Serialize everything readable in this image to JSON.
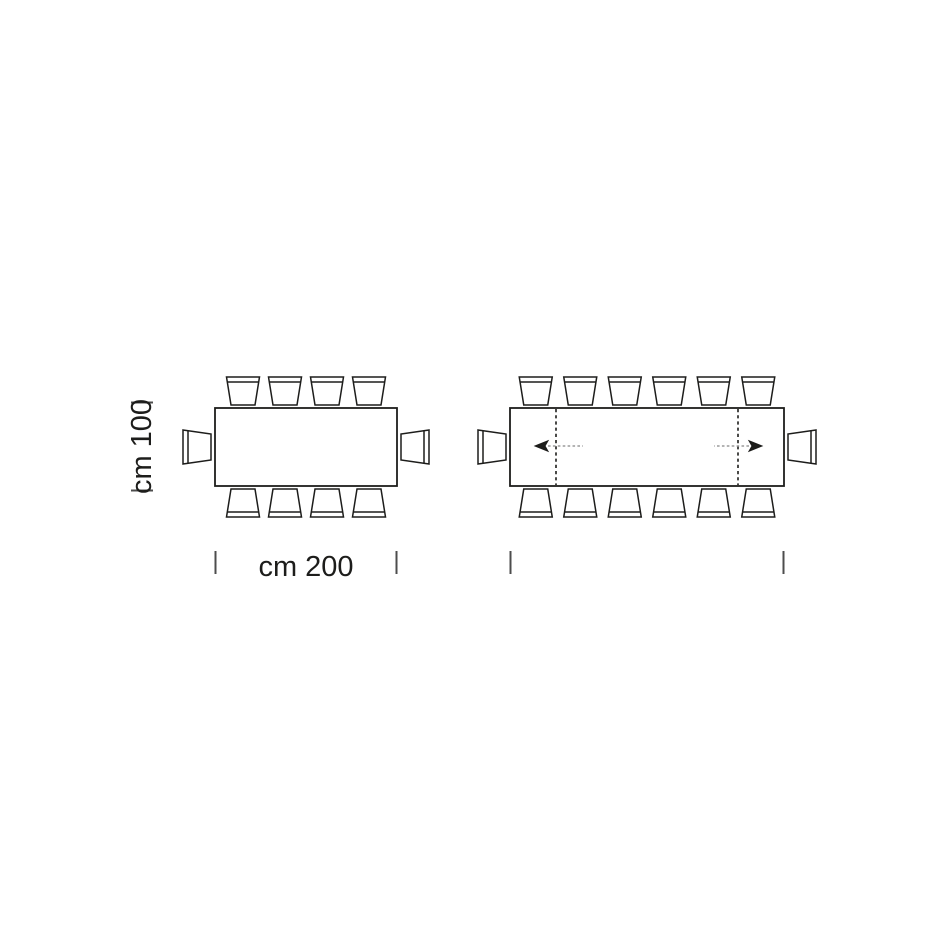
{
  "page": {
    "background_color": "#ffffff",
    "description": "Top-view dimension schematic of a rectangular dining table: closed version (left) and extended version with two extension leaves (right)"
  },
  "diagram": {
    "colors": {
      "line": "#1d1d1b",
      "tick": "#4d4d4d",
      "arrow_tail": "#9c9c9c",
      "table_fill": "#ffffff"
    },
    "labels": {
      "depth": "cm 100",
      "width": "cm 200"
    },
    "tables": [
      {
        "id": "closed-table",
        "seats_top": 4,
        "seats_bottom": 4,
        "seats_left": 1,
        "seats_right": 1,
        "total_seats": 10,
        "extended": false
      },
      {
        "id": "extended-table",
        "seats_top": 6,
        "seats_bottom": 6,
        "seats_left": 1,
        "seats_right": 1,
        "total_seats": 14,
        "extended": true,
        "extension_leaves": 2,
        "extension_direction": "outward"
      }
    ]
  }
}
